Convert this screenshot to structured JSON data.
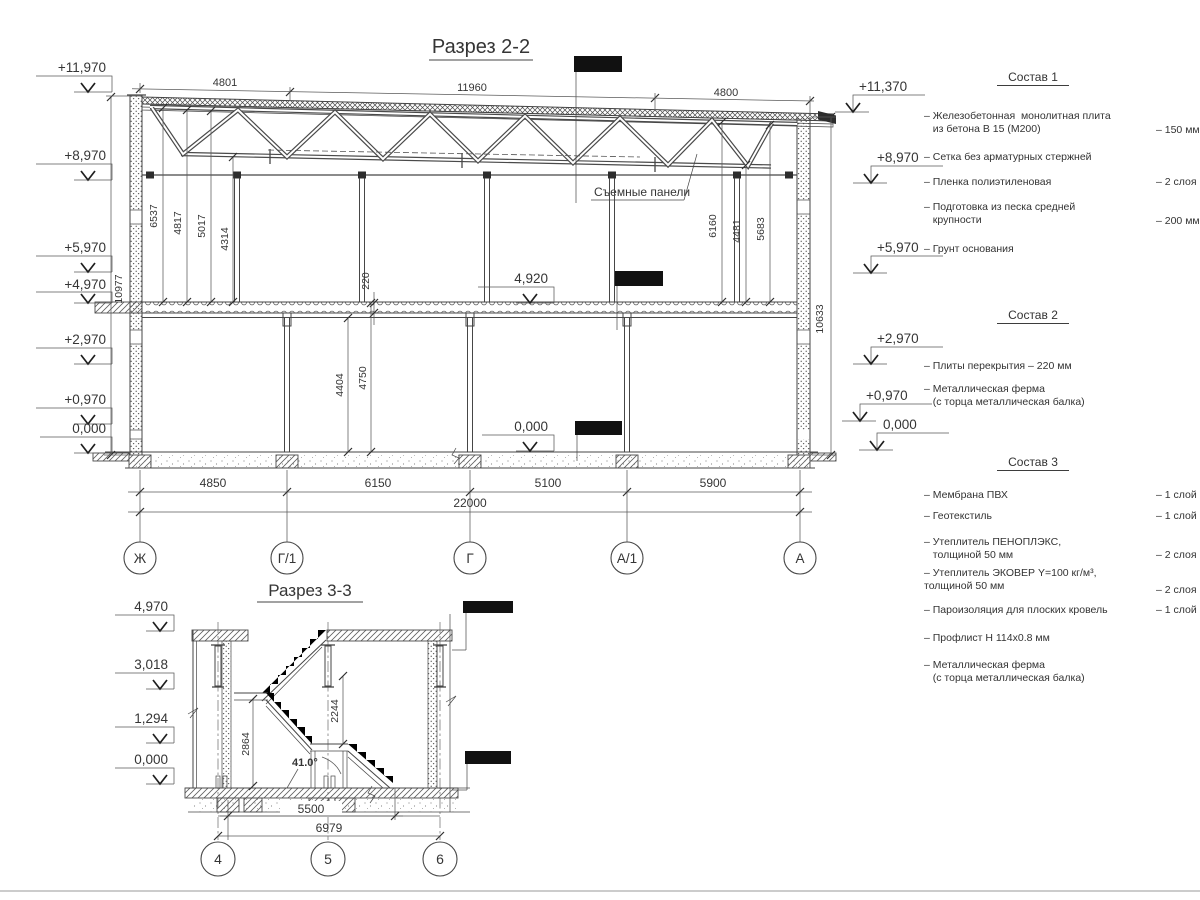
{
  "section22": {
    "title": "Разрез 2-2",
    "panels_label": "Съемные панели",
    "elev_left": [
      "+11,970",
      "+8,970",
      "+5,970",
      "+4,970",
      "+2,970",
      "+0,970",
      "0,000"
    ],
    "elev_right": [
      "+11,370",
      "+8,970",
      "+5,970",
      "+2,970",
      "+0,970",
      "0,000"
    ],
    "elev_mid": [
      "4,920",
      "0,000"
    ],
    "top_dims": [
      "4801",
      "11960",
      "4800"
    ],
    "roof_dims_left": [
      "6537",
      "4817",
      "5017",
      "4314"
    ],
    "roof_dims_right": [
      "6160",
      "4481",
      "5683"
    ],
    "slab_thickness": "220",
    "floor_dims": [
      "4404",
      "4750"
    ],
    "height_left": "10977",
    "height_right": "10633",
    "bottom_dims": [
      "4850",
      "6150",
      "5100",
      "5900"
    ],
    "total": "22000",
    "grid": [
      "Ж",
      "Г/1",
      "Г",
      "А/1",
      "А"
    ]
  },
  "section33": {
    "title": "Разрез 3-3",
    "elev": [
      "4,970",
      "3,018",
      "1,294",
      "0,000"
    ],
    "dims": [
      "2864",
      "2244"
    ],
    "angle": "41.0°",
    "bottom_dims": [
      "5500",
      "6979"
    ],
    "grid": [
      "4",
      "5",
      "6"
    ]
  },
  "notes": {
    "s1": {
      "title": "Состав 1",
      "items": [
        {
          "name": "– Железобетонная  монолитная плита\n   из бетона В 15 (М200)",
          "value": "– 150 мм"
        },
        {
          "name": "– Сетка без арматурных стержней",
          "value": ""
        },
        {
          "name": "– Пленка полиэтиленовая",
          "value": "–  2 слоя"
        },
        {
          "name": "– Подготовка из песка средней\n   крупности",
          "value": "– 200 мм"
        },
        {
          "name": "– Грунт основания",
          "value": ""
        }
      ]
    },
    "s2": {
      "title": "Состав 2",
      "items": [
        {
          "name": "– Плиты перекрытия – 220 мм",
          "value": ""
        },
        {
          "name": "– Металлическая ферма\n   (с торца металлическая балка)",
          "value": ""
        }
      ]
    },
    "s3": {
      "title": "Состав 3",
      "items": [
        {
          "name": "– Мембрана ПВХ",
          "value": "– 1 слой"
        },
        {
          "name": "– Геотекстиль",
          "value": "– 1 слой"
        },
        {
          "name": "– Утеплитель ПЕНОПЛЭКС,\n   толщиной 50 мм",
          "value": "– 2 слоя"
        },
        {
          "name": "– Утеплитель ЭКОВЕР Y=100 кг/м³,\nтолщиной 50 мм",
          "value": "– 2 слоя"
        },
        {
          "name": "– Пароизоляция для плоских кровель",
          "value": "– 1 слой"
        },
        {
          "name": "– Профлист Н 114х0.8 мм",
          "value": ""
        },
        {
          "name": "– Металлическая ферма\n   (с торца металлическая балка)",
          "value": ""
        }
      ]
    }
  }
}
